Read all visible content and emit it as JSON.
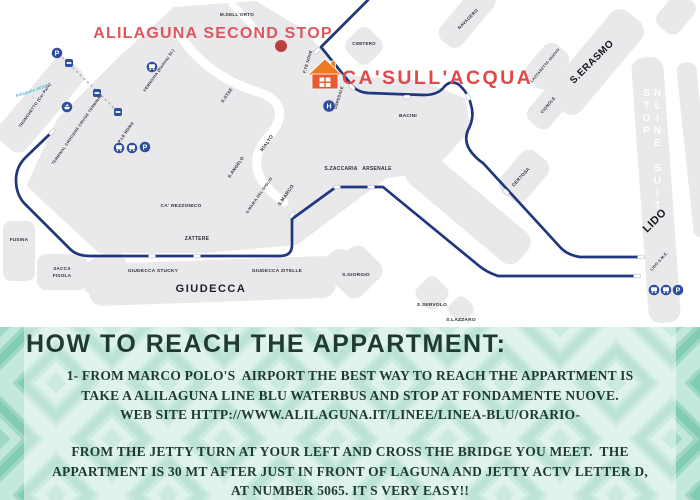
{
  "map": {
    "callouts": {
      "second_stop": "ALILAGUNA SECOND STOP",
      "property": "CA'SULL'ACQUA"
    },
    "watermark": "NLINE SUIT STOP",
    "labels": {
      "m_dellorto": "M.DELL'ORTO",
      "tronchetto": "TRONCHETTO (Car Park)",
      "alilaguna_sede": "Alilaguna SEDE",
      "terminal_crociere": "TERMINAL CROCIERE CRUISE TERMINAL",
      "ferrovia": "FERROVIA (Railway St.)",
      "ple_roma": "P.LE ROMA",
      "s_stae": "S.STAE",
      "f_te_nove": "F.TE NOVE",
      "cimitero": "CIMITERO",
      "navagero": "NAVAGERO",
      "lazzaretto_nuovo": "LAZZARETTO NUOVO",
      "s_erasmo": "S.ERASMO",
      "vignole": "VIGNOLE",
      "ospedale": "OSPEDALE",
      "bacini": "BACINI",
      "certosa": "CERTOSA",
      "rialto": "RIALTO",
      "s_angelo": "S.ANGELO",
      "ca_rezzonico": "CA' REZZONICO",
      "s_maria_giglio": "S.MARIA DEL GIGLIO",
      "s_marco": "S.MARCO",
      "s_zaccaria": "S.ZACCARIA",
      "arsenale": "ARSENALE",
      "zattere": "ZATTERE",
      "fusina": "FUSINA",
      "sacca": "SACCA",
      "fisola": "FISOLA",
      "giudecca_stucky": "GIUDECCA STUCKY",
      "giudecca_zitelle": "GIUDECCA ZITELLE",
      "giudecca": "GIUDECCA",
      "s_giorgio": "S.GIORGIO",
      "s_servolo": "S.SERVOLO",
      "s_lazzaro": "S.LAZZARO",
      "lido": "LIDO",
      "lido_sme": "LIDO S.M.E.",
      "parking": "P",
      "hospital": "H"
    },
    "colors": {
      "route": "#20377f",
      "island": "#e9e9ec",
      "icon_blue": "#2d4f9e",
      "red_dot": "#b8403e",
      "callout_pink": "#dd585e",
      "callout_red": "#e14848",
      "house_roof": "#ee7b22",
      "house_body": "#e65b31",
      "logo_cyan": "#35b6d9"
    }
  },
  "instructions": {
    "heading": "HOW TO REACH THE APPARTMENT:",
    "para1": [
      "1- FROM MARCO POLO'S  AIRPORT THE BEST WAY TO REACH THE APPARTMENT IS",
      "TAKE A ALILAGUNA LINE BLU WATERBUS AND STOP AT FONDAMENTE NUOVE.",
      "WEB SITE HTTP://WWW.ALILAGUNA.IT/LINEE/LINEA-BLU/ORARIO-"
    ],
    "para2": [
      "FROM THE JETTY TURN AT YOUR LEFT AND CROSS THE BRIDGE YOU MEET.  THE",
      "APPARTMENT IS 30 MT AFTER JUST IN FRONT OF LAGUNA AND JETTY ACTV LETTER D,",
      "AT NUMBER 5065. IT S VERY EASY!!"
    ],
    "colors": {
      "band_teal": "#9ed8c6",
      "text_dark": "#1f3a2e"
    }
  }
}
